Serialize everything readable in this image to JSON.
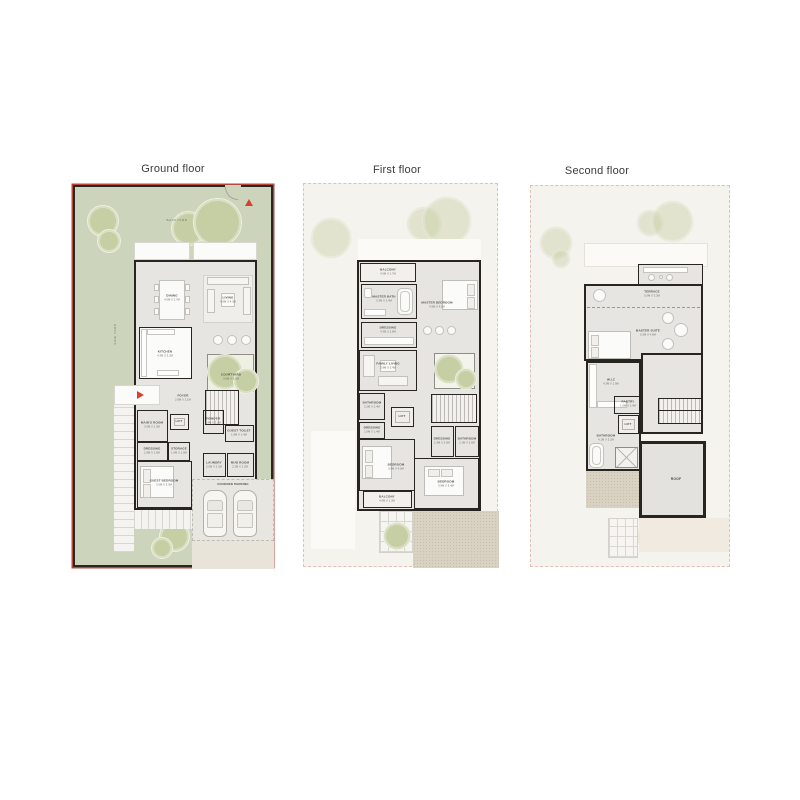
{
  "titles": {
    "ground": "Ground floor",
    "first": "First floor",
    "second": "Second floor"
  },
  "icons": {
    "gate": "red-triangle-up-arrow",
    "entry": "red-triangle-right-arrow"
  },
  "colors": {
    "garden_green": "#ccd5bb",
    "wall": "#28241f",
    "plot_outline_red": "#b5473c",
    "interior_gray": "#e6e5e2",
    "cream_plot": "#f5f3ee",
    "dashed_pink": "#e6beb6",
    "terrace_beige": "#d9d2c3",
    "tree_olive": "#c6cea3",
    "accent_red": "#d8402f"
  },
  "ground": {
    "labels": [
      {
        "name": "BACKYARD"
      },
      {
        "name": "SIDE YARD"
      },
      {
        "name": "DINING",
        "dims": "4.0M X 2.7M"
      },
      {
        "name": "LIVING",
        "dims": "4.6M X 4.3M"
      },
      {
        "name": "KITCHEN",
        "dims": "4.3M X 3.2M"
      },
      {
        "name": "COURTYARD",
        "dims": "3.6M X 3.2M"
      },
      {
        "name": "FOYER",
        "dims": "2.6M X 2.1M"
      },
      {
        "name": "LIFT"
      },
      {
        "name": "MAID'S ROOM",
        "dims": "3.0M X 2.3M"
      },
      {
        "name": "DRESSING",
        "dims": "1.8M X 1.5M"
      },
      {
        "name": "STORAGE",
        "dims": "1.6M X 1.5M"
      },
      {
        "name": "POWDER",
        "dims": "1.4M X 2.2M"
      },
      {
        "name": "GUEST TOILET",
        "dims": "1.8M X 1.4M"
      },
      {
        "name": "LAUNDRY",
        "dims": "2.0M X 2.2M"
      },
      {
        "name": "MUD ROOM",
        "dims": "2.2M X 2.2M"
      },
      {
        "name": "GUEST BEDROOM",
        "dims": "3.6M X 3.3M"
      },
      {
        "name": "COVERED PARKING"
      }
    ]
  },
  "first": {
    "labels": [
      {
        "name": "BALCONY",
        "dims": "4.0M X 1.7M"
      },
      {
        "name": "MASTER BATH",
        "dims": "3.3M X 2.4M"
      },
      {
        "name": "MASTER BEDROOM",
        "dims": "4.5M X 4.1M"
      },
      {
        "name": "DRESSING",
        "dims": "4.3M X 1.8M"
      },
      {
        "name": "FAMILY LIVING",
        "dims": "3.9M X 3.4M"
      },
      {
        "name": "BATHROOM",
        "dims": "2.2M X 2.4M"
      },
      {
        "name": "DRESSING",
        "dims": "2.0M X 1.4M"
      },
      {
        "name": "LIFT"
      },
      {
        "name": "BEDROOM",
        "dims": "3.6M X 4.0M"
      },
      {
        "name": "BALCONY",
        "dims": "4.0M X 1.3M"
      },
      {
        "name": "DRESSING",
        "dims": "1.9M X 2.6M"
      },
      {
        "name": "BATHROOM",
        "dims": "2.1M X 2.6M"
      },
      {
        "name": "BEDROOM",
        "dims": "3.9M X 3.4M"
      }
    ]
  },
  "second": {
    "labels": [
      {
        "name": "TERRACE",
        "dims": "5.0M X 3.3M"
      },
      {
        "name": "MASTER SUITE",
        "dims": "5.5M X 4.6M"
      },
      {
        "name": "W.I.C",
        "dims": "4.3M X 1.9M"
      },
      {
        "name": "PANTRY",
        "dims": "1.5M X 1.4M"
      },
      {
        "name": "LIFT"
      },
      {
        "name": "BATHROOM",
        "dims": "4.1M X 3.2M"
      },
      {
        "name": "ROOF"
      }
    ]
  }
}
